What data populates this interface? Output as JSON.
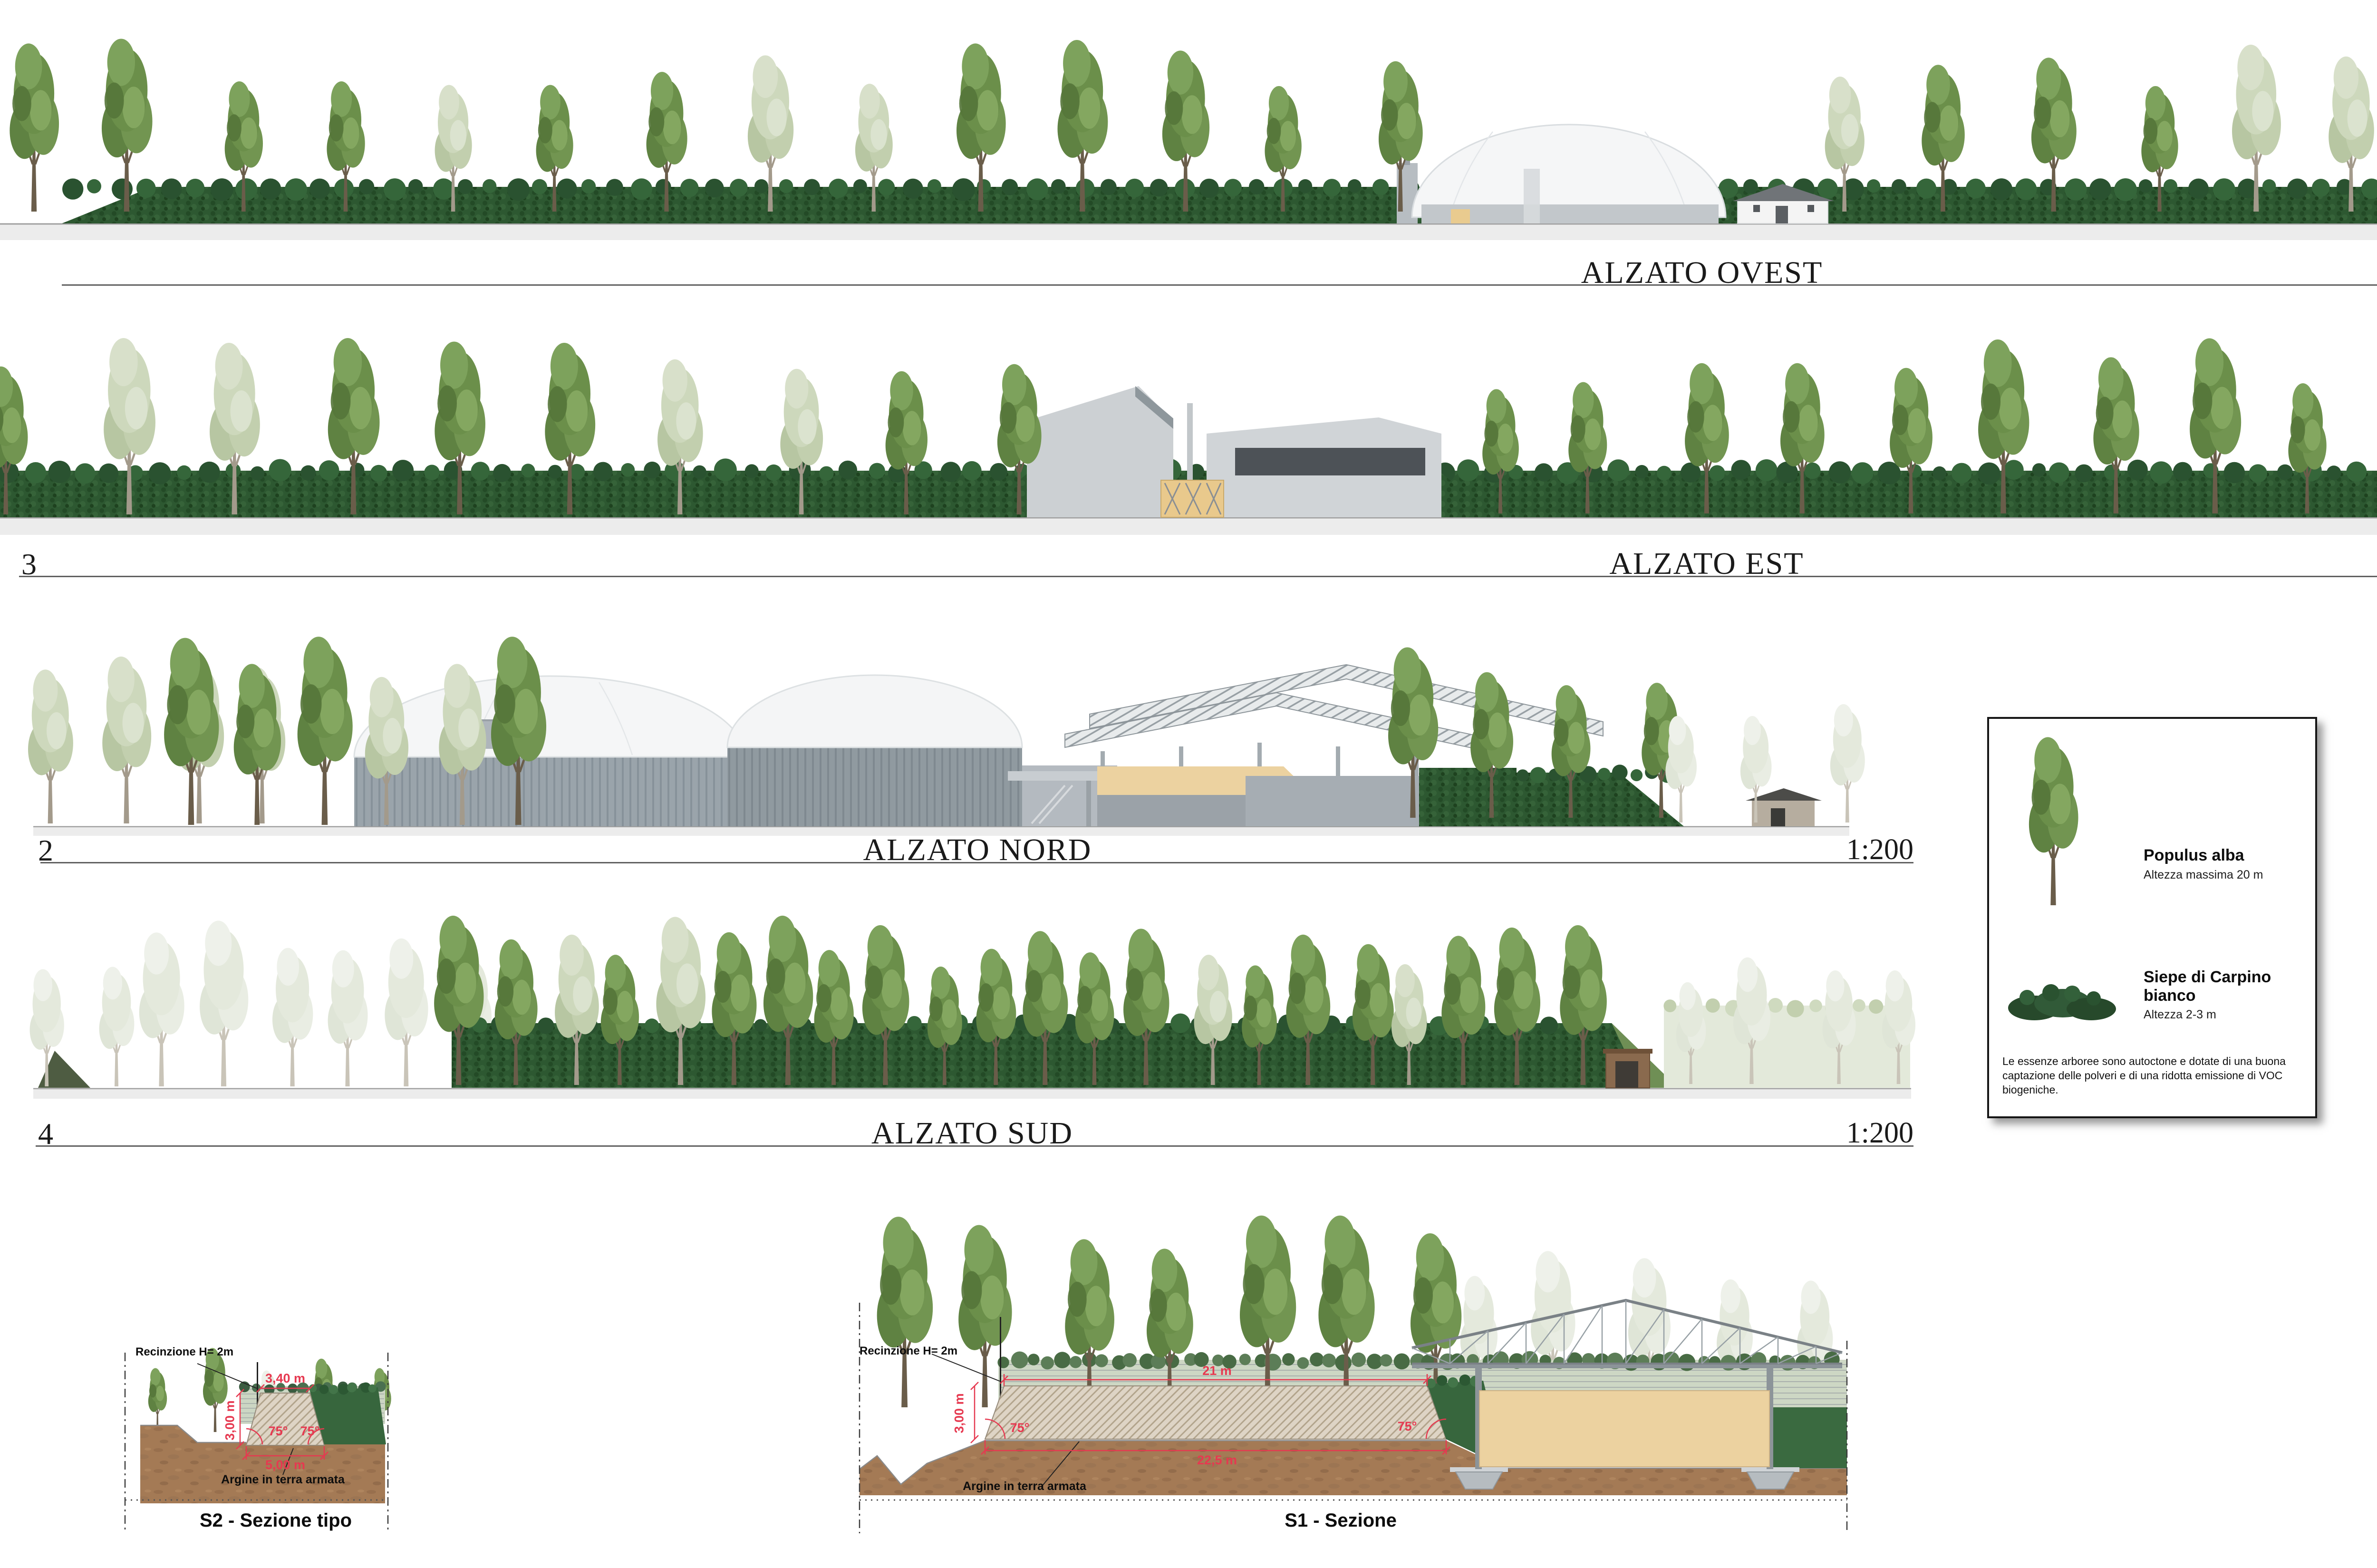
{
  "elevations": [
    {
      "number": "",
      "title": "ALZATO OVEST",
      "scale": "1:200"
    },
    {
      "number": "3",
      "title": "ALZATO EST",
      "scale": "1:200"
    },
    {
      "number": "2",
      "title": "ALZATO NORD",
      "scale": "1:200"
    },
    {
      "number": "4",
      "title": "ALZATO SUD",
      "scale": "1:200"
    }
  ],
  "legend": {
    "items": [
      {
        "icon": "poplar-tree-icon",
        "name": "Populus alba",
        "detail": "Altezza massima 20 m"
      },
      {
        "icon": "hornbeam-hedge-icon",
        "name": "Siepe di Carpino bianco",
        "detail": "Altezza 2-3 m"
      }
    ],
    "note": "Le essenze arboree sono autoctone e dotate di una buona captazione delle polveri e di una ridotta emissione di VOC biogeniche."
  },
  "sections": [
    {
      "title": "S2 - Sezione tipo",
      "fence_label": "Recinzione H= 2m",
      "embankment_label": "Argine in terra armata",
      "dim_top_width": "3,40 m",
      "dim_height": "3,00 m",
      "dim_base_width": "5,00 m",
      "angle_left": "75°",
      "angle_right": "75°"
    },
    {
      "title": "S1 - Sezione",
      "fence_label": "Recinzione H= 2m",
      "embankment_label": "Argine in terra armata",
      "dim_top_width": "21 m",
      "dim_height": "3,00 m",
      "dim_base_width": "22,5 m",
      "angle_left": "75°",
      "angle_right": "75°"
    }
  ],
  "colors": {
    "dimension_red": "#e63950",
    "hedge_green": "#2d5831",
    "soil_brown": "#a47a55",
    "sand_fill": "#ecd2a0"
  }
}
